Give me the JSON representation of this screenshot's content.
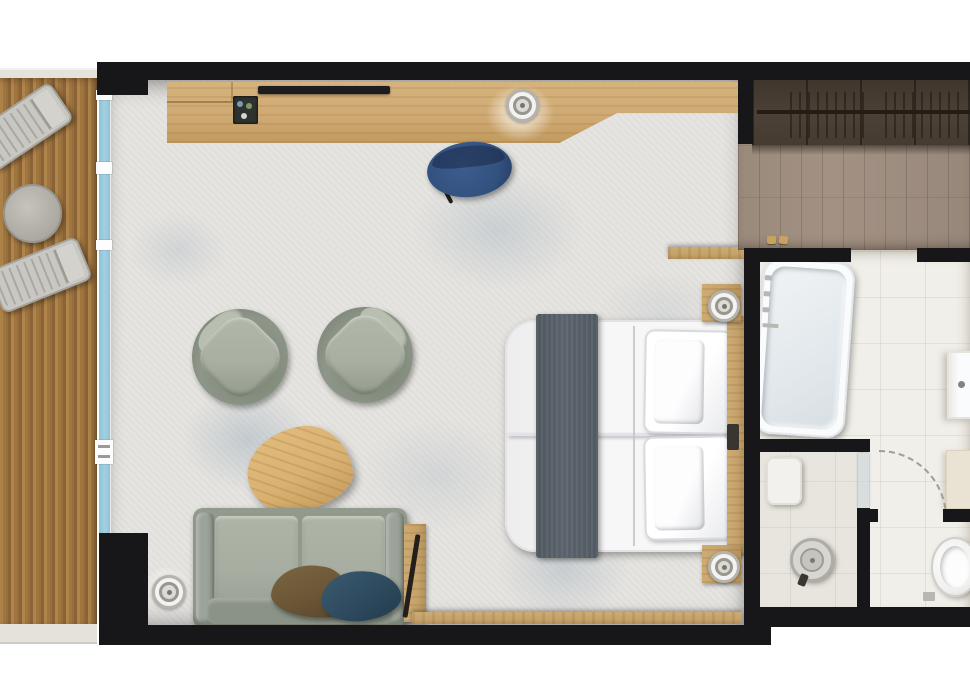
{
  "meta": {
    "type": "floor-plan",
    "scene": "hotel-suite-top-down",
    "canvas": {
      "width": 970,
      "height": 700
    }
  },
  "palette": {
    "wall": "#17171a",
    "terrace_cap": "#e5e2db",
    "deck_light": "#b0854b",
    "deck_mid": "#a07540",
    "deck_dark": "#8a6336",
    "glass": "#a3d0e2",
    "carpet": "#e6e4e0",
    "carpet_accent": "#9fb4c4",
    "desk_wood": "#cfa973",
    "tv": "#1d1d1f",
    "chair_blue": "#32517e",
    "armchair_body": "#8d9689",
    "armchair_cushion": "#a9b0a2",
    "table_wood": "#d9b273",
    "sofa_body": "#929a8e",
    "sofa_cushion": "#a7aea1",
    "pillow_brown": "#6b5636",
    "pillow_teal": "#2e4a5e",
    "bed_white": "#f7f7f8",
    "bed_shade": "#e2e3e6",
    "runner": "#5a626b",
    "oak": "#c5a26b",
    "wardrobe": "#4c4136",
    "entry_floor": "#a39284",
    "tile": "#f1efe9",
    "fixture_white": "#fafbfc",
    "metal": "#b9b7b2",
    "cream": "#eae2d2"
  },
  "rooms": [
    {
      "name": "terrace",
      "features": [
        "wood-deck",
        "lounger-1",
        "lounger-2",
        "side-table"
      ]
    },
    {
      "name": "living-bedroom",
      "features": [
        "sliding-glass-wall",
        "desk-console",
        "tv",
        "minibar-tray",
        "desk-lamp",
        "desk-chair",
        "armchair-1",
        "armchair-2",
        "coffee-table",
        "sofa",
        "pillow-brown",
        "pillow-teal",
        "valet-stand",
        "floor-lamp",
        "double-bed",
        "bed-runner",
        "headboard",
        "nightstand-1",
        "nightstand-2",
        "bedside-lamp-1",
        "bedside-lamp-2",
        "window-ledge"
      ]
    },
    {
      "name": "entry",
      "features": [
        "wardrobe-with-hangers",
        "wood-floor",
        "slippers"
      ]
    },
    {
      "name": "bathroom",
      "features": [
        "bathtub",
        "vanity-sink",
        "storage-cabinet"
      ]
    },
    {
      "name": "shower-room",
      "features": [
        "rain-shower-head",
        "shower-bench",
        "glass-door"
      ]
    },
    {
      "name": "wc",
      "features": [
        "toilet",
        "door-swing-arc"
      ]
    }
  ]
}
